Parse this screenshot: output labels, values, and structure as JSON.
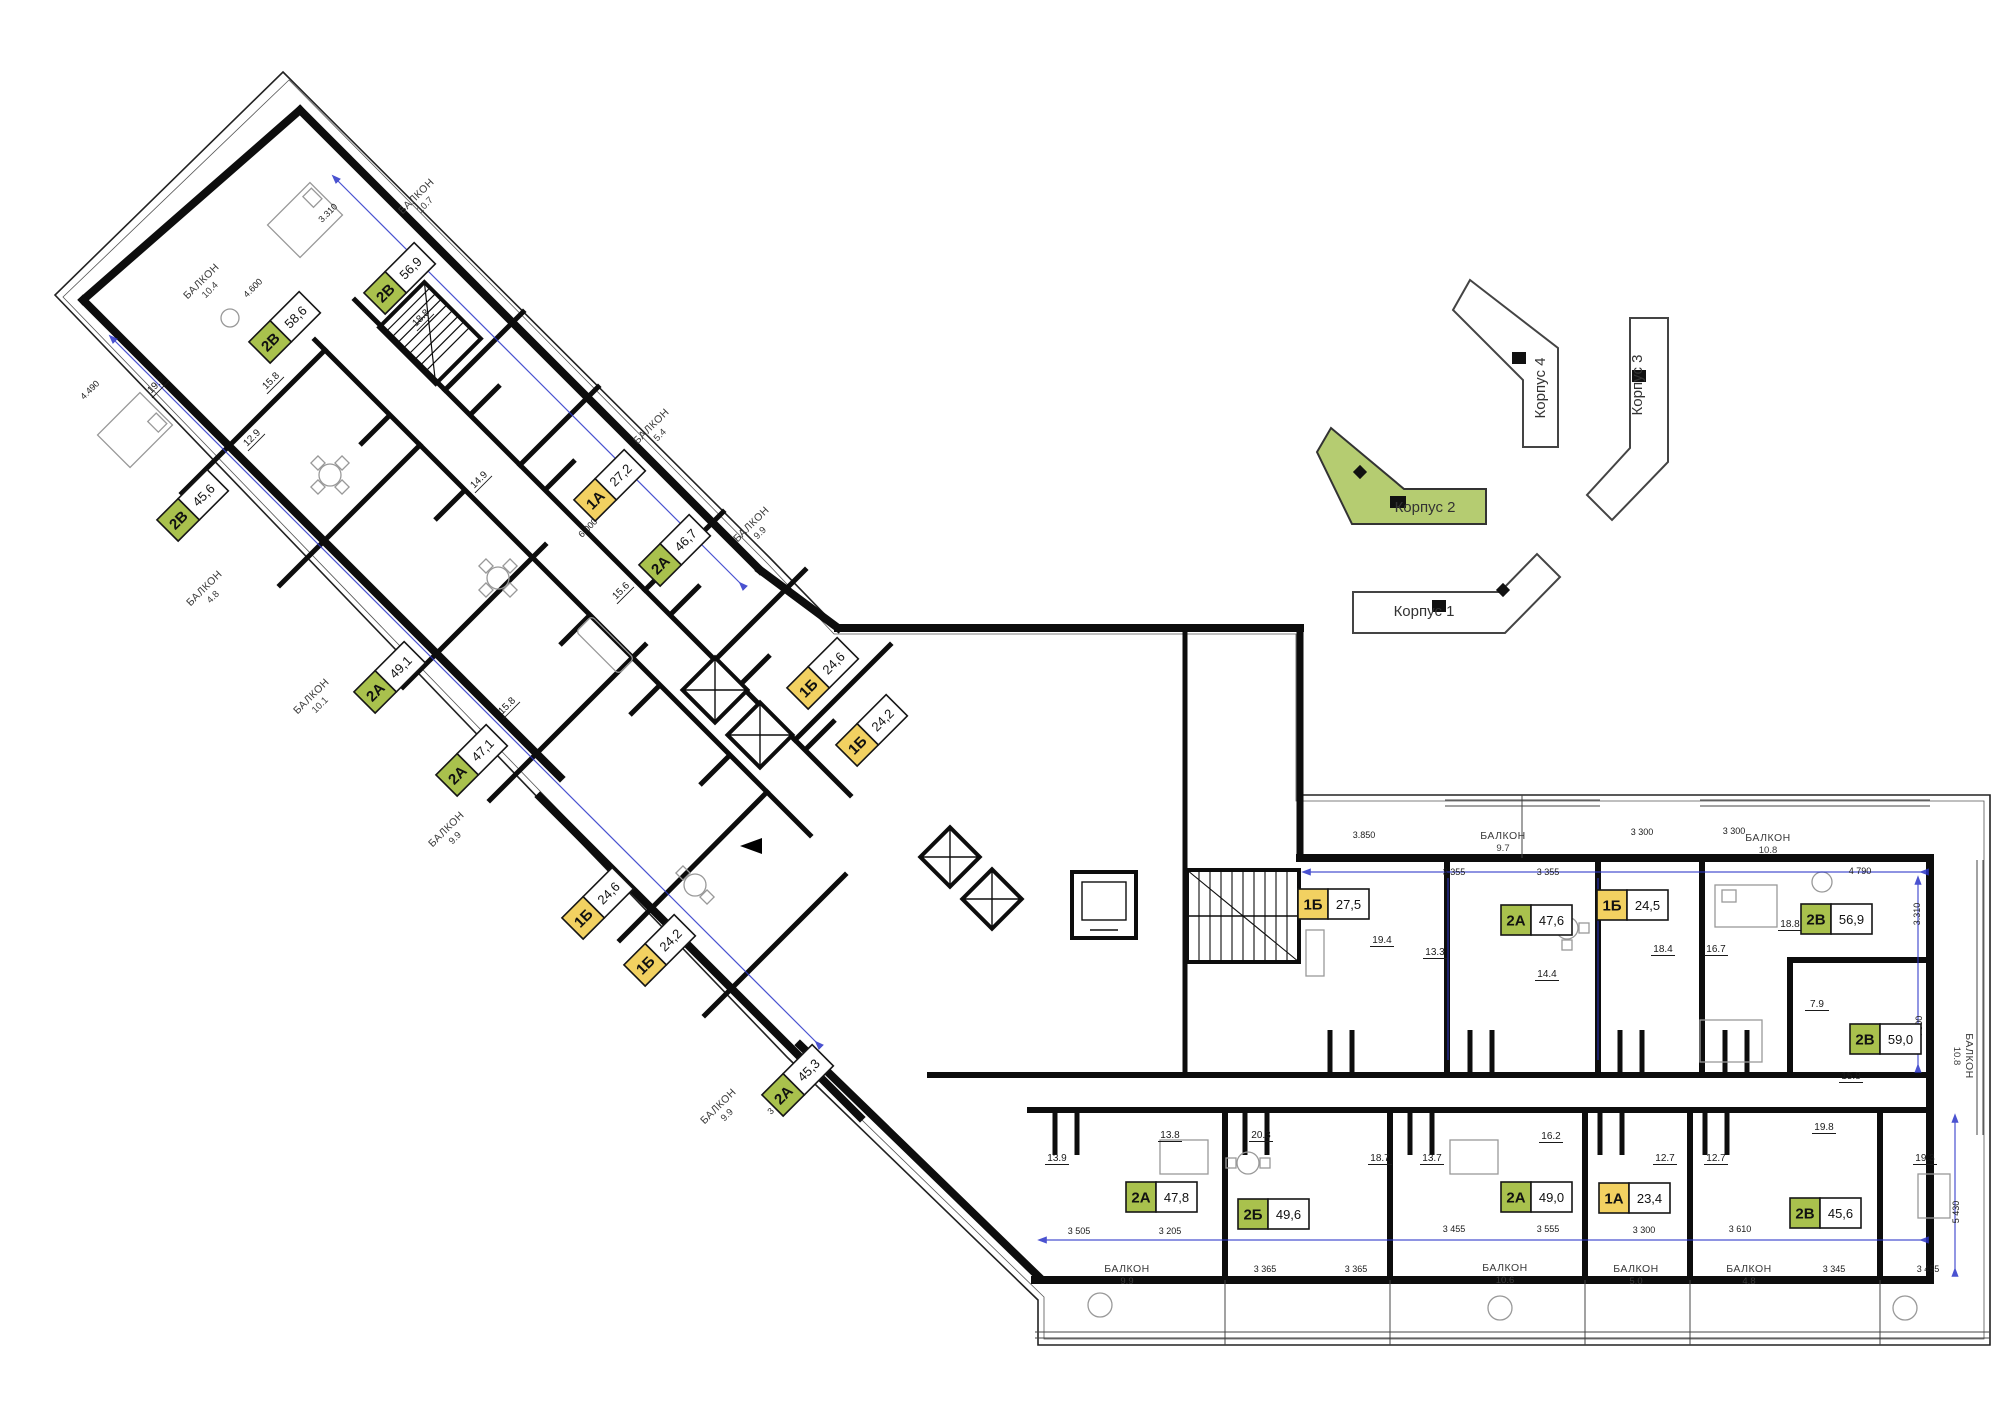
{
  "colors": {
    "badge_green": "#a9c14d",
    "badge_yellow": "#f2d161",
    "site_green": "#b5cc71",
    "dim_blue": "#2b35c8",
    "wall": "#0d0d0d",
    "text": "#1a1a1a"
  },
  "apartments": [
    {
      "type": "2В",
      "area": "58,6",
      "x": 285,
      "y": 327,
      "rot": -45
    },
    {
      "type": "2В",
      "area": "56,9",
      "x": 400,
      "y": 278,
      "rot": -45
    },
    {
      "type": "2В",
      "area": "45,6",
      "x": 193,
      "y": 505,
      "rot": -45
    },
    {
      "type": "2А",
      "area": "49,1",
      "x": 390,
      "y": 677,
      "rot": -45
    },
    {
      "type": "2А",
      "area": "47,1",
      "x": 472,
      "y": 760,
      "rot": -45
    },
    {
      "type": "1А",
      "area": "27,2",
      "x": 610,
      "y": 485,
      "rot": -45
    },
    {
      "type": "2А",
      "area": "46,7",
      "x": 675,
      "y": 550,
      "rot": -45
    },
    {
      "type": "1Б",
      "area": "24,6",
      "x": 823,
      "y": 673,
      "rot": -45
    },
    {
      "type": "1Б",
      "area": "24,2",
      "x": 872,
      "y": 730,
      "rot": -45
    },
    {
      "type": "1Б",
      "area": "24,6",
      "x": 598,
      "y": 903,
      "rot": -45
    },
    {
      "type": "1Б",
      "area": "24,2",
      "x": 660,
      "y": 950,
      "rot": -45
    },
    {
      "type": "2А",
      "area": "45,3",
      "x": 798,
      "y": 1080,
      "rot": -45
    },
    {
      "type": "1Б",
      "area": "27,5",
      "x": 1334,
      "y": 904,
      "rot": 0
    },
    {
      "type": "2А",
      "area": "47,6",
      "x": 1537,
      "y": 920,
      "rot": 0
    },
    {
      "type": "1Б",
      "area": "24,5",
      "x": 1633,
      "y": 905,
      "rot": 0
    },
    {
      "type": "2В",
      "area": "56,9",
      "x": 1837,
      "y": 919,
      "rot": 0
    },
    {
      "type": "2В",
      "area": "59,0",
      "x": 1886,
      "y": 1039,
      "rot": 0
    },
    {
      "type": "2А",
      "area": "47,8",
      "x": 1162,
      "y": 1197,
      "rot": 0
    },
    {
      "type": "2Б",
      "area": "49,6",
      "x": 1274,
      "y": 1214,
      "rot": 0
    },
    {
      "type": "2А",
      "area": "49,0",
      "x": 1537,
      "y": 1197,
      "rot": 0
    },
    {
      "type": "1А",
      "area": "23,4",
      "x": 1635,
      "y": 1198,
      "rot": 0
    },
    {
      "type": "2В",
      "area": "45,6",
      "x": 1826,
      "y": 1213,
      "rot": 0
    }
  ],
  "balconies": [
    {
      "label": "БАЛКОН",
      "value": "10.7",
      "x": 420,
      "y": 200,
      "rot": -45
    },
    {
      "label": "БАЛКОН",
      "value": "10.4",
      "x": 205,
      "y": 285,
      "rot": -45
    },
    {
      "label": "БАЛКОН",
      "value": "4.8",
      "x": 208,
      "y": 592,
      "rot": -45
    },
    {
      "label": "БАЛКОН",
      "value": "10.1",
      "x": 315,
      "y": 700,
      "rot": -45
    },
    {
      "label": "БАЛКОН",
      "value": "9.9",
      "x": 450,
      "y": 833,
      "rot": -45
    },
    {
      "label": "БАЛКОН",
      "value": "5.4",
      "x": 655,
      "y": 430,
      "rot": -45
    },
    {
      "label": "БАЛКОН",
      "value": "9.9",
      "x": 755,
      "y": 528,
      "rot": -45
    },
    {
      "label": "БАЛКОН",
      "value": "9.9",
      "x": 722,
      "y": 1110,
      "rot": -45
    },
    {
      "label": "БАЛКОН",
      "value": "9.7",
      "x": 1503,
      "y": 841,
      "rot": 0
    },
    {
      "label": "БАЛКОН",
      "value": "10.8",
      "x": 1768,
      "y": 843,
      "rot": 0
    },
    {
      "label": "БАЛКОН",
      "value": "10.8",
      "x": 1964,
      "y": 1056,
      "rot": 90
    },
    {
      "label": "БАЛКОН",
      "value": "9.9",
      "x": 1127,
      "y": 1274,
      "rot": 0
    },
    {
      "label": "БАЛКОН",
      "value": "10.6",
      "x": 1505,
      "y": 1273,
      "rot": 0
    },
    {
      "label": "БАЛКОН",
      "value": "5.0",
      "x": 1636,
      "y": 1274,
      "rot": 0
    },
    {
      "label": "БАЛКОН",
      "value": "4.8",
      "x": 1749,
      "y": 1274,
      "rot": 0
    }
  ],
  "site_plan": {
    "buildings": [
      {
        "name": "Корпус 4",
        "x": 1545,
        "y": 388,
        "rot": -90,
        "highlight": false
      },
      {
        "name": "Корпус 3",
        "x": 1642,
        "y": 385,
        "rot": -90,
        "highlight": false
      },
      {
        "name": "Корпус 2",
        "x": 1425,
        "y": 512,
        "rot": 0,
        "highlight": true
      },
      {
        "name": "Корпус 1",
        "x": 1424,
        "y": 616,
        "rot": 0,
        "highlight": false
      }
    ]
  },
  "rooms": [
    {
      "t": "19.2",
      "x": 158,
      "y": 387,
      "rot": -45
    },
    {
      "t": "15.8",
      "x": 273,
      "y": 383,
      "rot": -45
    },
    {
      "t": "18.8",
      "x": 423,
      "y": 320,
      "rot": -45
    },
    {
      "t": "12.9",
      "x": 254,
      "y": 440,
      "rot": -45
    },
    {
      "t": "14.9",
      "x": 481,
      "y": 482,
      "rot": -45
    },
    {
      "t": "15.6",
      "x": 623,
      "y": 593,
      "rot": -45
    },
    {
      "t": "15.8",
      "x": 509,
      "y": 708,
      "rot": -45
    },
    {
      "t": "19.4",
      "x": 1382,
      "y": 943,
      "rot": 0
    },
    {
      "t": "13.3",
      "x": 1435,
      "y": 955,
      "rot": 0
    },
    {
      "t": "14.4",
      "x": 1547,
      "y": 977,
      "rot": 0
    },
    {
      "t": "18.4",
      "x": 1663,
      "y": 952,
      "rot": 0
    },
    {
      "t": "16.7",
      "x": 1716,
      "y": 952,
      "rot": 0
    },
    {
      "t": "18.8",
      "x": 1790,
      "y": 927,
      "rot": 0
    },
    {
      "t": "7.9",
      "x": 1817,
      "y": 1007,
      "rot": 0
    },
    {
      "t": "15.8",
      "x": 1851,
      "y": 1079,
      "rot": 0
    },
    {
      "t": "13.8",
      "x": 1170,
      "y": 1138,
      "rot": 0
    },
    {
      "t": "20.3",
      "x": 1261,
      "y": 1138,
      "rot": 0
    },
    {
      "t": "13.9",
      "x": 1057,
      "y": 1161,
      "rot": 0
    },
    {
      "t": "13.7",
      "x": 1432,
      "y": 1161,
      "rot": 0
    },
    {
      "t": "18.7",
      "x": 1380,
      "y": 1161,
      "rot": 0
    },
    {
      "t": "16.2",
      "x": 1551,
      "y": 1139,
      "rot": 0
    },
    {
      "t": "12.7",
      "x": 1665,
      "y": 1161,
      "rot": 0
    },
    {
      "t": "12.7",
      "x": 1716,
      "y": 1161,
      "rot": 0
    },
    {
      "t": "19.8",
      "x": 1824,
      "y": 1130,
      "rot": 0
    },
    {
      "t": "19.3",
      "x": 1925,
      "y": 1161,
      "rot": 0
    }
  ],
  "dims": [
    {
      "t": "4.600",
      "x": 255,
      "y": 290,
      "rot": -45
    },
    {
      "t": "3.310",
      "x": 330,
      "y": 215,
      "rot": -45
    },
    {
      "t": "4.490",
      "x": 92,
      "y": 392,
      "rot": -45
    },
    {
      "t": "6.000",
      "x": 590,
      "y": 530,
      "rot": -45
    },
    {
      "t": "3 300",
      "x": 779,
      "y": 1107,
      "rot": -45
    },
    {
      "t": "3.850",
      "x": 1364,
      "y": 838,
      "rot": 0
    },
    {
      "t": "3 355",
      "x": 1454,
      "y": 875,
      "rot": 0
    },
    {
      "t": "3 355",
      "x": 1548,
      "y": 875,
      "rot": 0
    },
    {
      "t": "3 300",
      "x": 1642,
      "y": 835,
      "rot": 0
    },
    {
      "t": "3 300",
      "x": 1734,
      "y": 834,
      "rot": 0
    },
    {
      "t": "4 790",
      "x": 1860,
      "y": 874,
      "rot": 0
    },
    {
      "t": "3.310",
      "x": 1920,
      "y": 914,
      "rot": -90
    },
    {
      "t": "4 800",
      "x": 1922,
      "y": 1027,
      "rot": -90
    },
    {
      "t": "3 505",
      "x": 1079,
      "y": 1234,
      "rot": 0
    },
    {
      "t": "3 205",
      "x": 1170,
      "y": 1234,
      "rot": 0
    },
    {
      "t": "3 365",
      "x": 1265,
      "y": 1272,
      "rot": 0
    },
    {
      "t": "3 365",
      "x": 1356,
      "y": 1272,
      "rot": 0
    },
    {
      "t": "3 455",
      "x": 1454,
      "y": 1232,
      "rot": 0
    },
    {
      "t": "3 555",
      "x": 1548,
      "y": 1232,
      "rot": 0
    },
    {
      "t": "3 300",
      "x": 1644,
      "y": 1233,
      "rot": 0
    },
    {
      "t": "3 610",
      "x": 1740,
      "y": 1232,
      "rot": 0
    },
    {
      "t": "3 345",
      "x": 1834,
      "y": 1272,
      "rot": 0
    },
    {
      "t": "3 455",
      "x": 1928,
      "y": 1272,
      "rot": 0
    },
    {
      "t": "5 430",
      "x": 1959,
      "y": 1212,
      "rot": -90
    }
  ]
}
